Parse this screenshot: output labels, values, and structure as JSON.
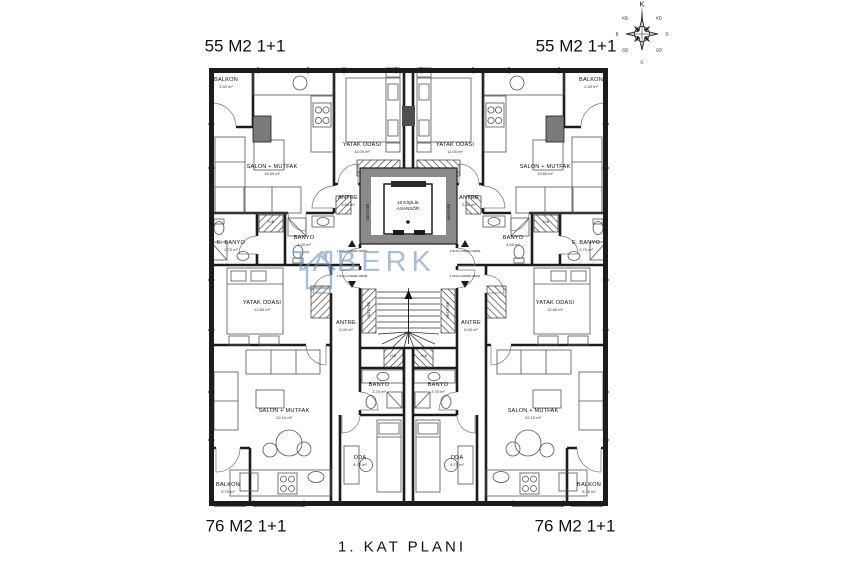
{
  "plan_title": "1. KAT PLANI",
  "units": {
    "top_left": "55 M2 1+1",
    "top_right": "55 M2 1+1",
    "bottom_left": "76 M2 1+1",
    "bottom_right": "76 M2 1+1"
  },
  "rooms": {
    "tl": {
      "balkon": {
        "name": "BALKON",
        "area": "2.40 m²"
      },
      "salon": {
        "name": "SALON + MUTFAK",
        "area": "19.60 m²"
      },
      "yatak": {
        "name": "YATAK ODASI",
        "area": "11.00 m²"
      },
      "antre": {
        "name": "ANTRE",
        "area": "3.60 m²"
      },
      "banyo": {
        "name": "BANYO",
        "area": "4.00 m²"
      },
      "ebanyo": {
        "name": "E. BANYO",
        "area": "2.70 m²"
      },
      "hb": "H.B"
    },
    "tr": {
      "balkon": {
        "name": "BALKON",
        "area": "2.40 m²"
      },
      "salon": {
        "name": "SALON + MUTFAK",
        "area": "19.60 m²"
      },
      "yatak": {
        "name": "YATAK ODASI",
        "area": "11.00 m²"
      },
      "antre": {
        "name": "ANTRE",
        "area": "3.60 m²"
      },
      "banyo": {
        "name": "BANYO",
        "area": "4.00 m²"
      },
      "ebanyo": {
        "name": "E. BANYO",
        "area": "2.70 m²"
      },
      "hb": "H.B"
    },
    "bl": {
      "yatak": {
        "name": "YATAK ODASI",
        "area": "12.80 m²"
      },
      "antre": {
        "name": "ANTRE",
        "area": "6.00 m²"
      },
      "salon": {
        "name": "SALON + MUTFAK",
        "area": "22.10 m²"
      },
      "banyo": {
        "name": "BANYO",
        "area": "3.70 m²"
      },
      "oda": {
        "name": "ODA",
        "area": "8.70 m²"
      },
      "balkon": {
        "name": "BALKON",
        "area": "5.70 m²"
      },
      "hb": "H.B"
    },
    "br": {
      "yatak": {
        "name": "YATAK ODASI",
        "area": "12.80 m²"
      },
      "antre": {
        "name": "ANTRE",
        "area": "6.00 m²"
      },
      "salon": {
        "name": "SALON + MUTFAK",
        "area": "22.10 m²"
      },
      "banyo": {
        "name": "BANYO",
        "area": "3.70 m²"
      },
      "oda": {
        "name": "ODA",
        "area": "8.70 m²"
      },
      "balkon": {
        "name": "BALKON",
        "area": "5.70 m²"
      },
      "hb": "H.B"
    }
  },
  "core": {
    "elevator_line1": "10 KİŞİLİK",
    "elevator_line2": "ASANSÖR",
    "vestiyer": "VESTİYER"
  },
  "entrances": [
    "1 NOLU DAİRE GİRİŞİ",
    "2 NOLU DAİRE GİRİŞİ",
    "3 NOLU DAİRE GİRİŞİ",
    "4 NOLU DAİRE GİRİŞİ"
  ],
  "compass": {
    "points": [
      "K",
      "KD",
      "D",
      "GD",
      "G",
      "GB",
      "B",
      "KB"
    ]
  },
  "watermark": "TABERK",
  "colors": {
    "wall": "#1c1c1c",
    "core_gray": "#8a8a8a",
    "watermark_blue": "#6f93bd"
  }
}
